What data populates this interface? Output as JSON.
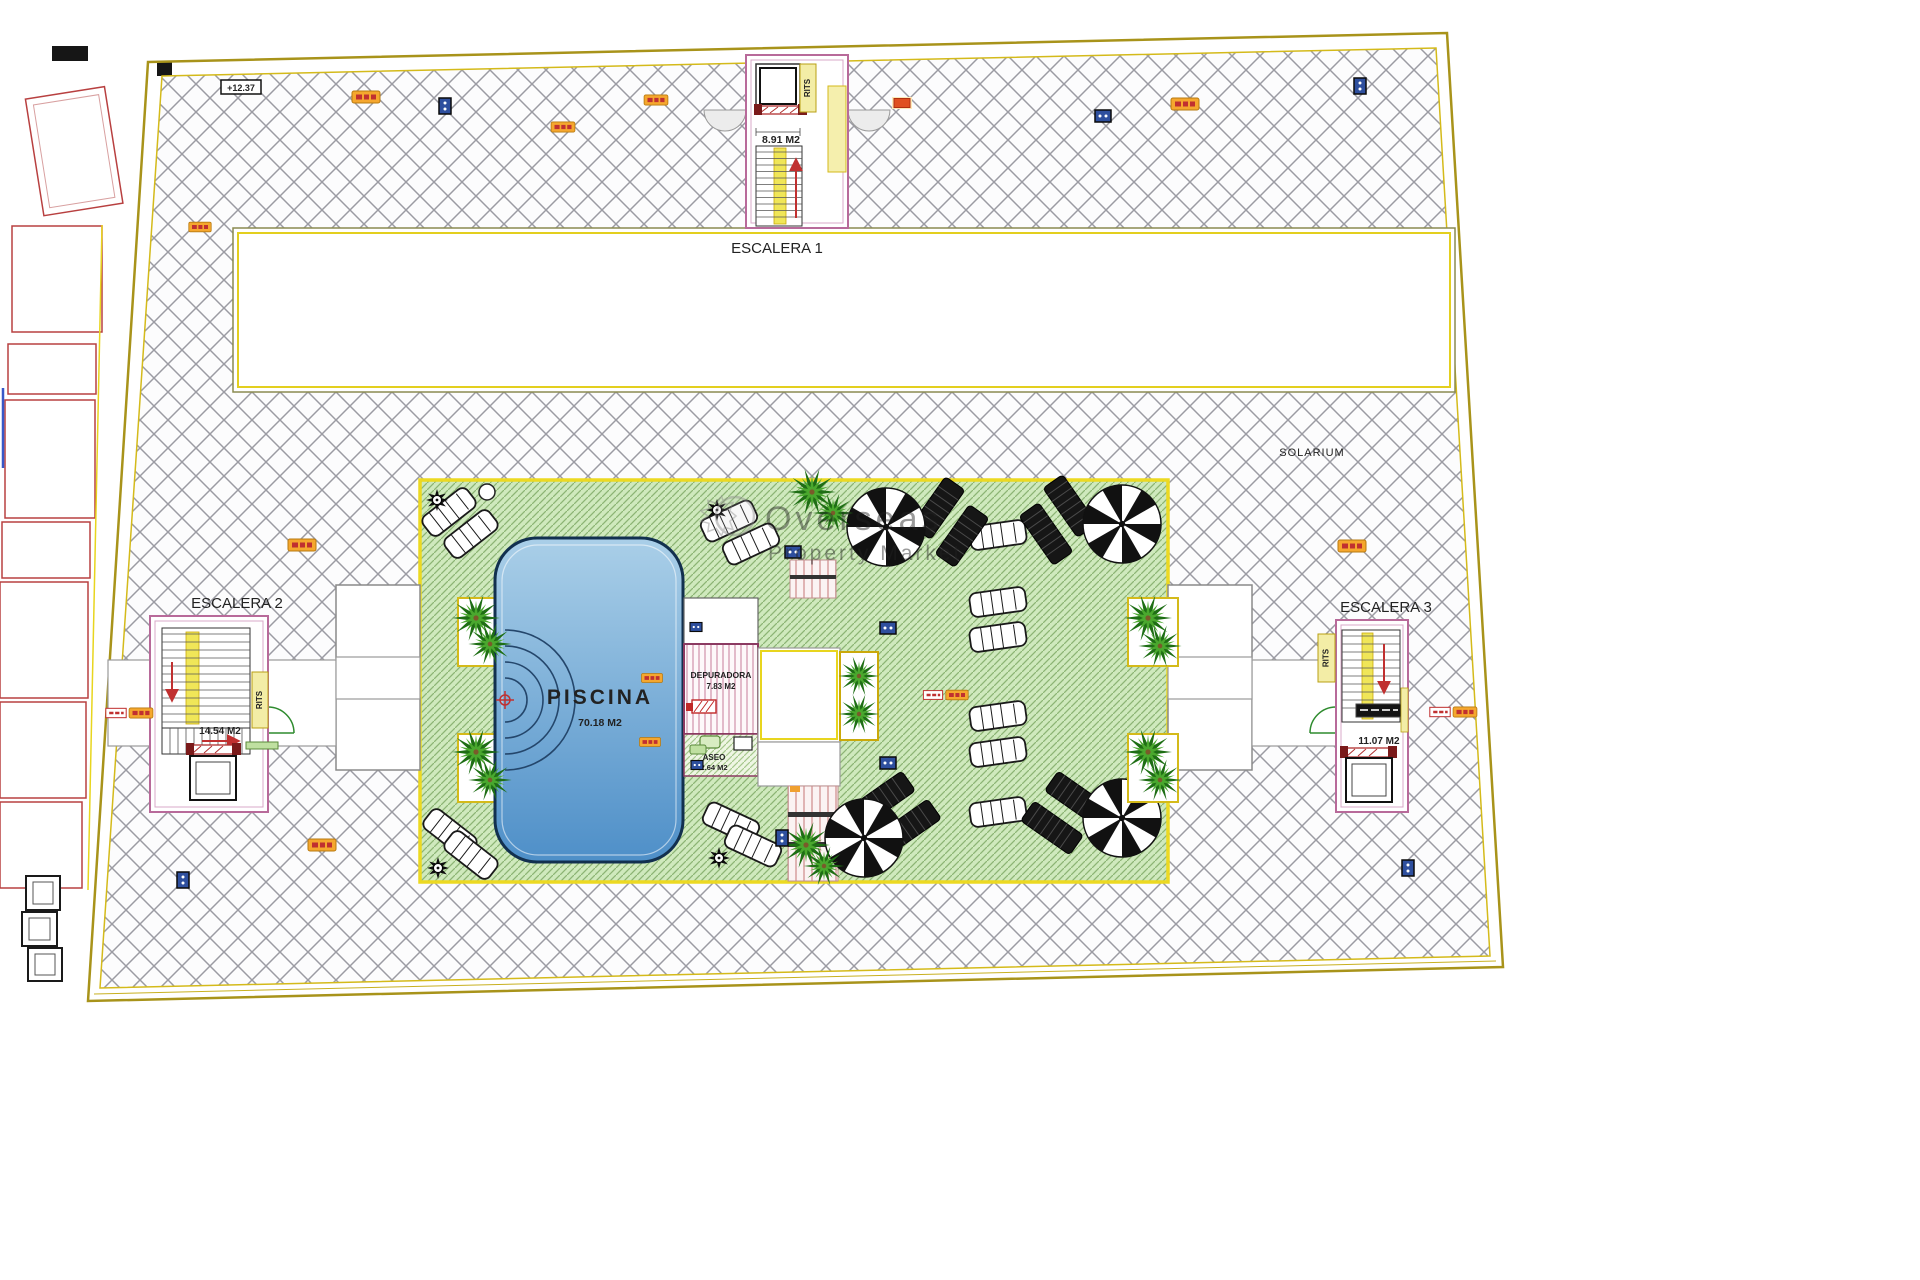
{
  "plan": {
    "solarium_label": "SOLARIUM",
    "level_marker": "+12.37",
    "stairs": {
      "escalera1": {
        "name": "ESCALERA 1",
        "area": "8.91 M2",
        "shaft": "RITS"
      },
      "escalera2": {
        "name": "ESCALERA 2",
        "area": "14.54 M2",
        "shaft": "RITS"
      },
      "escalera3": {
        "name": "ESCALERA 3",
        "area": "11.07 M2",
        "shaft": "RITS"
      }
    },
    "pool": {
      "name": "PISCINA",
      "area": "70.18 M2"
    },
    "rooms": {
      "depuradora": {
        "name": "DEPURADORA",
        "area": "7.83 M2"
      },
      "aseo": {
        "name": "ASEO",
        "area": "2.64 M2"
      }
    }
  },
  "watermark": {
    "line1": "Overseas",
    "line2": "Property Market"
  },
  "colors": {
    "boundary_yellow": "#c8ae16",
    "wall_pink": "#b86a9a",
    "hatch_gray": "#9b9ba3",
    "lawn_green": "#cfe9bd",
    "pool_blue": "#5795cc",
    "stair_yellow": "#f0e658",
    "marker_orange": "#f5a72e",
    "marker_blue": "#2e4f9e",
    "arrow_red": "#c03030"
  }
}
